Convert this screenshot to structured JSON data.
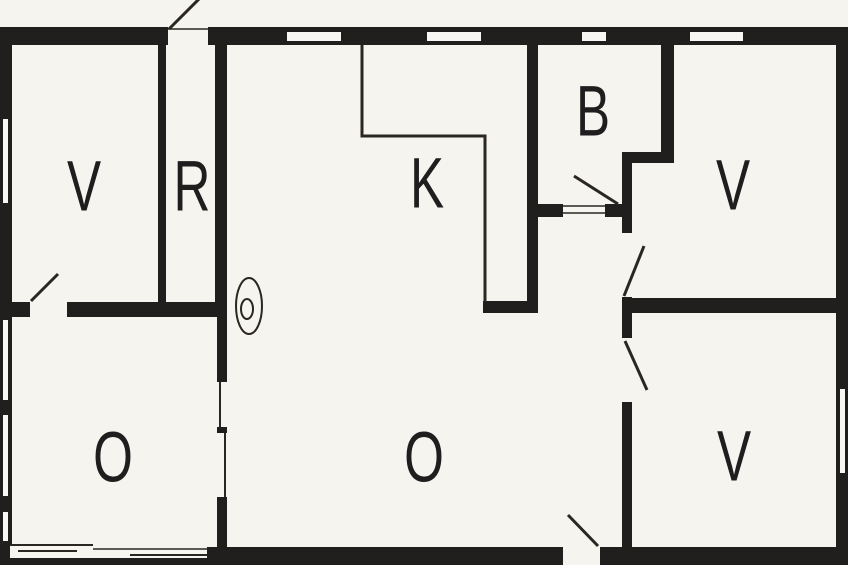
{
  "floorplan": {
    "rooms": [
      {
        "label": "V",
        "name": "room-v-top-left"
      },
      {
        "label": "R",
        "name": "room-r-entry"
      },
      {
        "label": "K",
        "name": "room-k-kitchen"
      },
      {
        "label": "B",
        "name": "room-b-bath"
      },
      {
        "label": "V",
        "name": "room-v-top-right"
      },
      {
        "label": "O",
        "name": "room-o-bottom-left"
      },
      {
        "label": "O",
        "name": "room-o-living"
      },
      {
        "label": "V",
        "name": "room-v-bottom-right"
      }
    ],
    "symbols": [
      {
        "name": "doorbell-symbol",
        "shape": "concentric-circles"
      }
    ],
    "colors": {
      "wall": "#211e1e",
      "background": "#f5f4ef",
      "line": "#2a2622"
    }
  }
}
